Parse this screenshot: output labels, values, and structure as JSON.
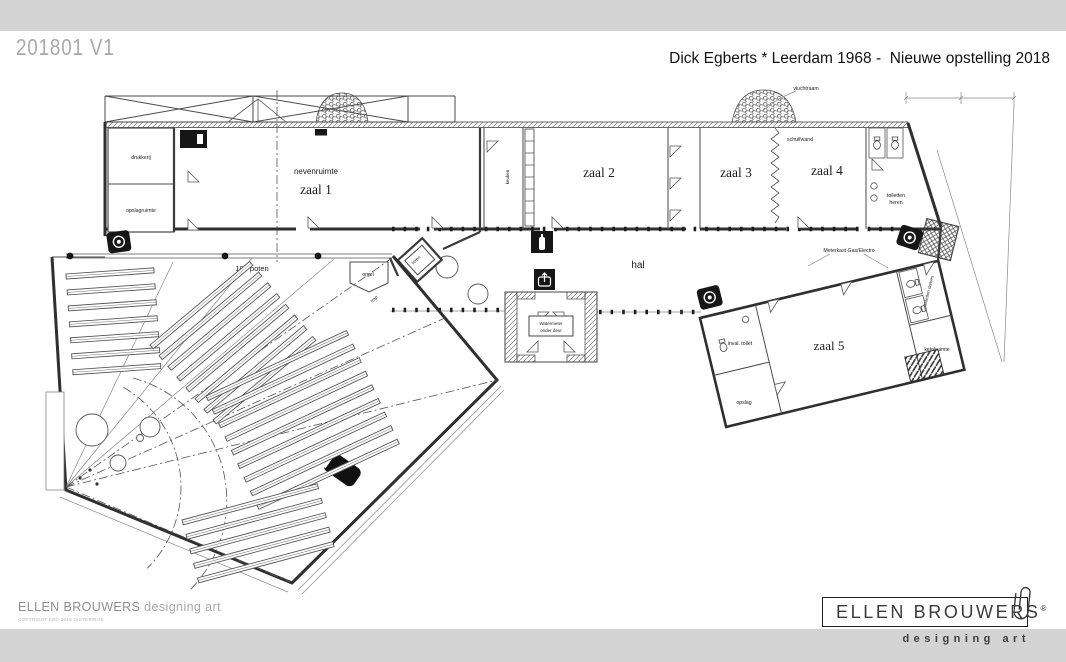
{
  "header": {
    "version": "201801 V1",
    "title": "Dick Egberts * Leerdam 1968 -  Nieuwe opstelling 2018"
  },
  "plan": {
    "labels": {
      "drukkerij": "drukkerij",
      "opslagruimte": "opslagruimte",
      "nevenruimte": "nevenruimte",
      "zaal1": "zaal 1",
      "keuken": "keuken",
      "zaal2": "zaal 2",
      "zaal3": "zaal 3",
      "schuifwand": "schuifwand",
      "zaal4": "zaal 4",
      "toiletten": "toiletten",
      "heren": "heren",
      "vluchtraam": "vluchtraam",
      "hal": "hal",
      "honderd_poten": "100 poten",
      "orgel": "orgel",
      "toren": "toren",
      "trap": "trap",
      "vestibule_line1": "Watermeter",
      "vestibule_line2": "onder deur",
      "zaal5": "zaal 5",
      "inval_toilet": "inval. toilet",
      "opslag": "opslag",
      "ketelruimte": "ketelruimte",
      "toiletten_dames": "toiletten dames",
      "meterkast": "Meterkast  Gas/Electro"
    }
  },
  "footer": {
    "studio_name": "ELLEN BROUWERS",
    "studio_tagline": "designing art",
    "copyright": "COPYRIGHT EB© 2018 OISTERWIJK"
  },
  "logo": {
    "name": "ELLEN BROUWERS",
    "registered": "®",
    "tagline": "designing art"
  },
  "colors": {
    "band_gray": "#d3d3d3",
    "line_dark": "#333333",
    "paper": "#ffffff"
  }
}
